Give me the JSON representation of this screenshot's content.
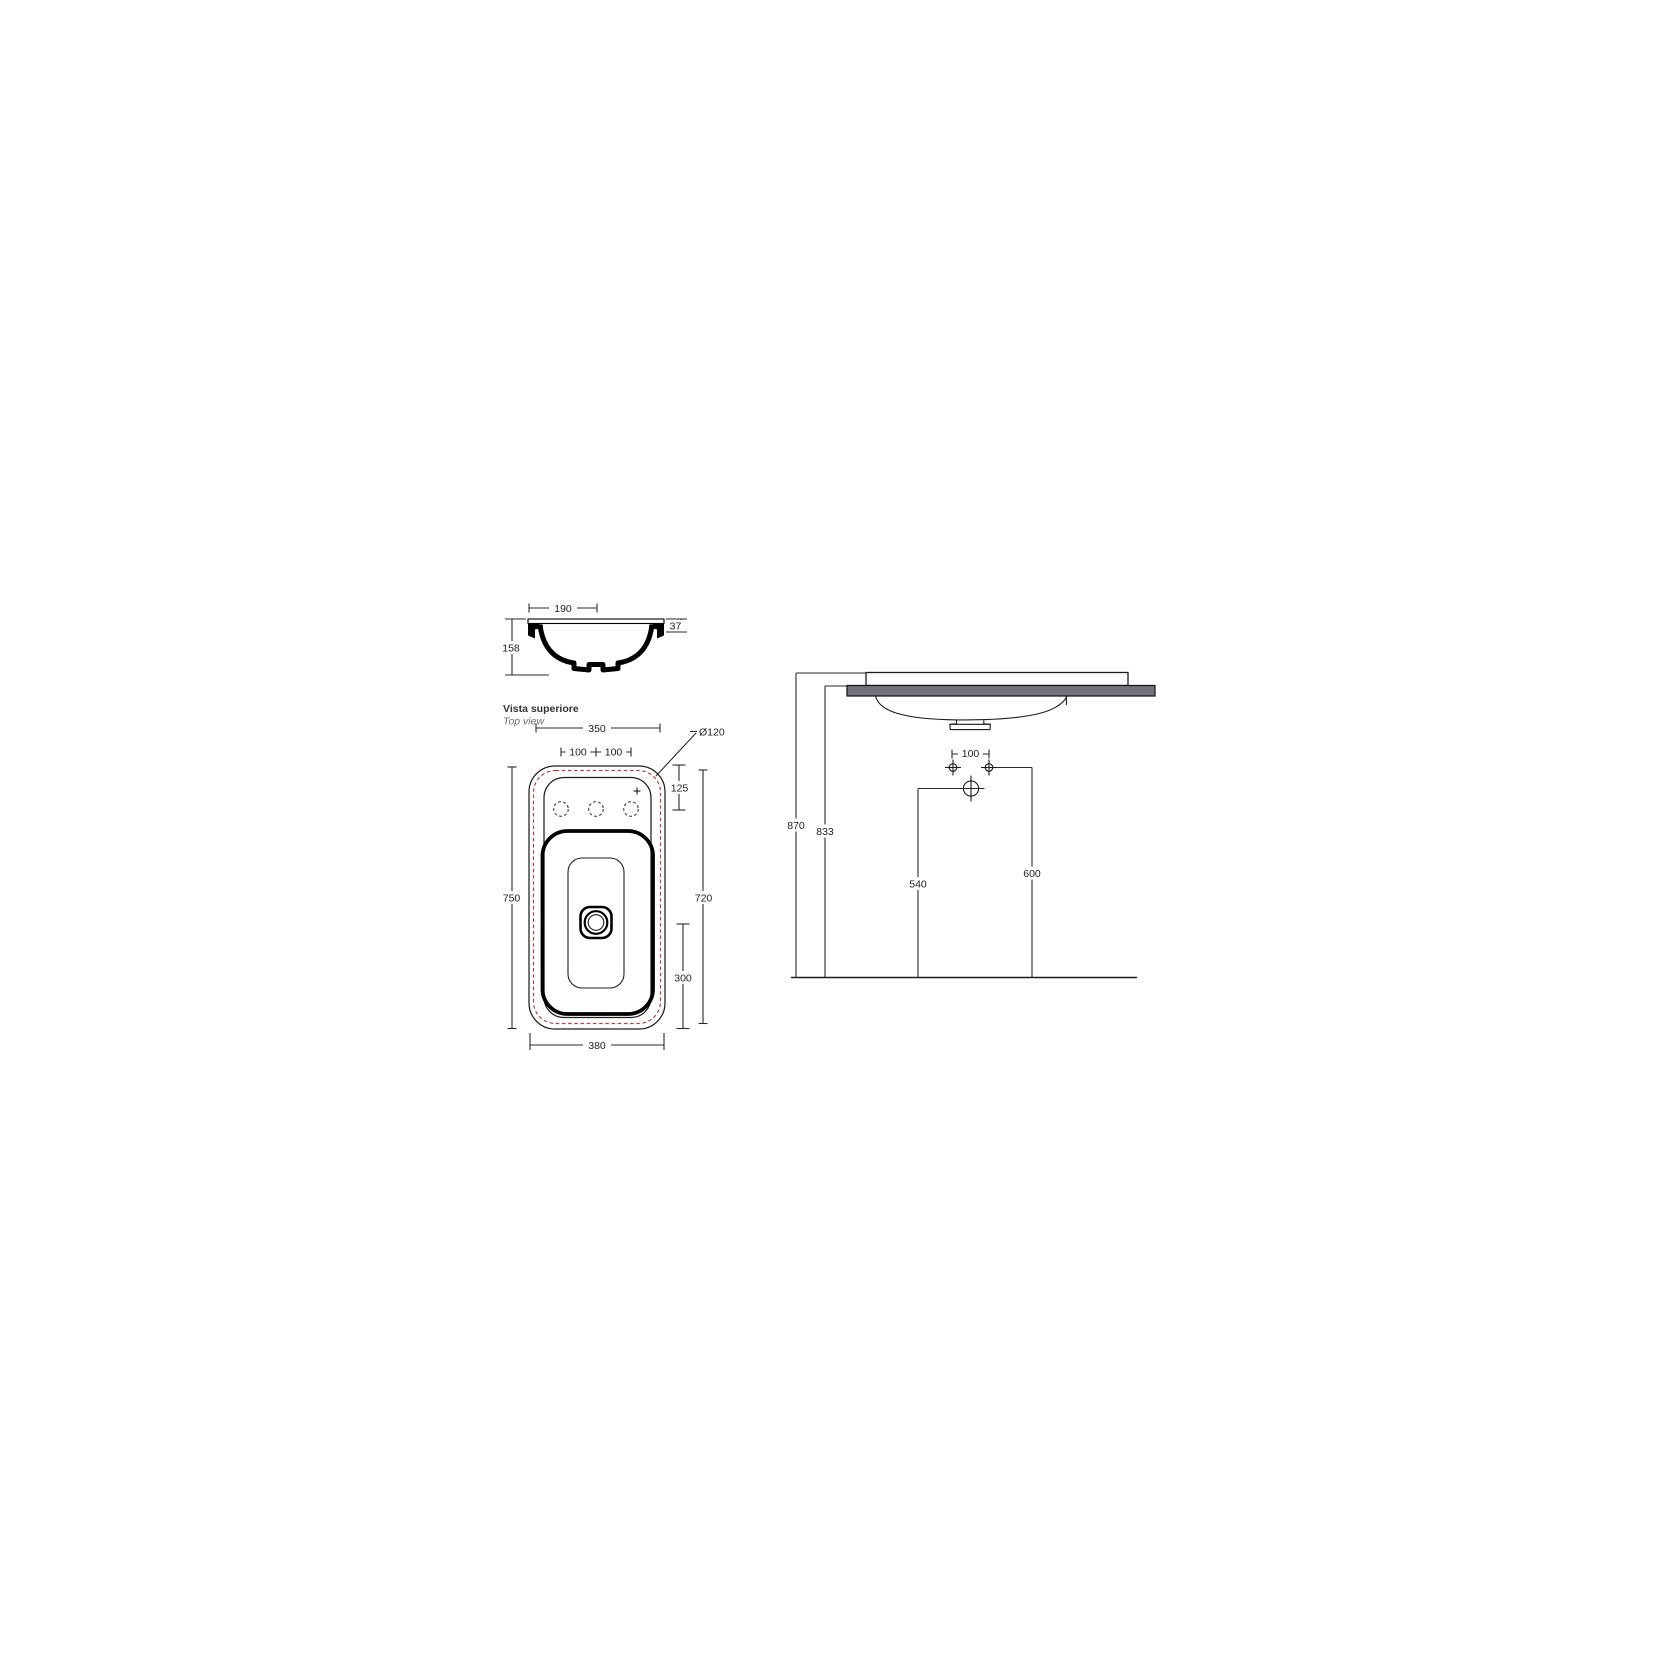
{
  "document": {
    "type": "technical-drawing",
    "subject": "washbasin dimensional drawing"
  },
  "colors": {
    "cutout_red": "#b2463e",
    "counter_gray": "#73737b",
    "line_black": "#1d1d1d"
  },
  "section_view": {
    "dim_top_width": "190",
    "dim_rim_height": "37",
    "dim_bowl_depth": "158"
  },
  "top_view": {
    "title": "Vista superiore",
    "subtitle": "Top view",
    "dim_cutout_width": "350",
    "dim_hole_spacing_left": "100",
    "dim_hole_spacing_right": "100",
    "dim_cutout_corner": "Ø120",
    "dim_holes_offset": "125",
    "dim_overall_depth": "750",
    "dim_cutout_depth": "720",
    "dim_drain_offset": "300",
    "dim_overall_width": "380"
  },
  "front_view": {
    "dim_rim_height_floor": "870",
    "dim_counter_height_floor": "833",
    "dim_drain_height": "540",
    "dim_fixing_height": "600",
    "dim_fixing_spacing": "100"
  }
}
